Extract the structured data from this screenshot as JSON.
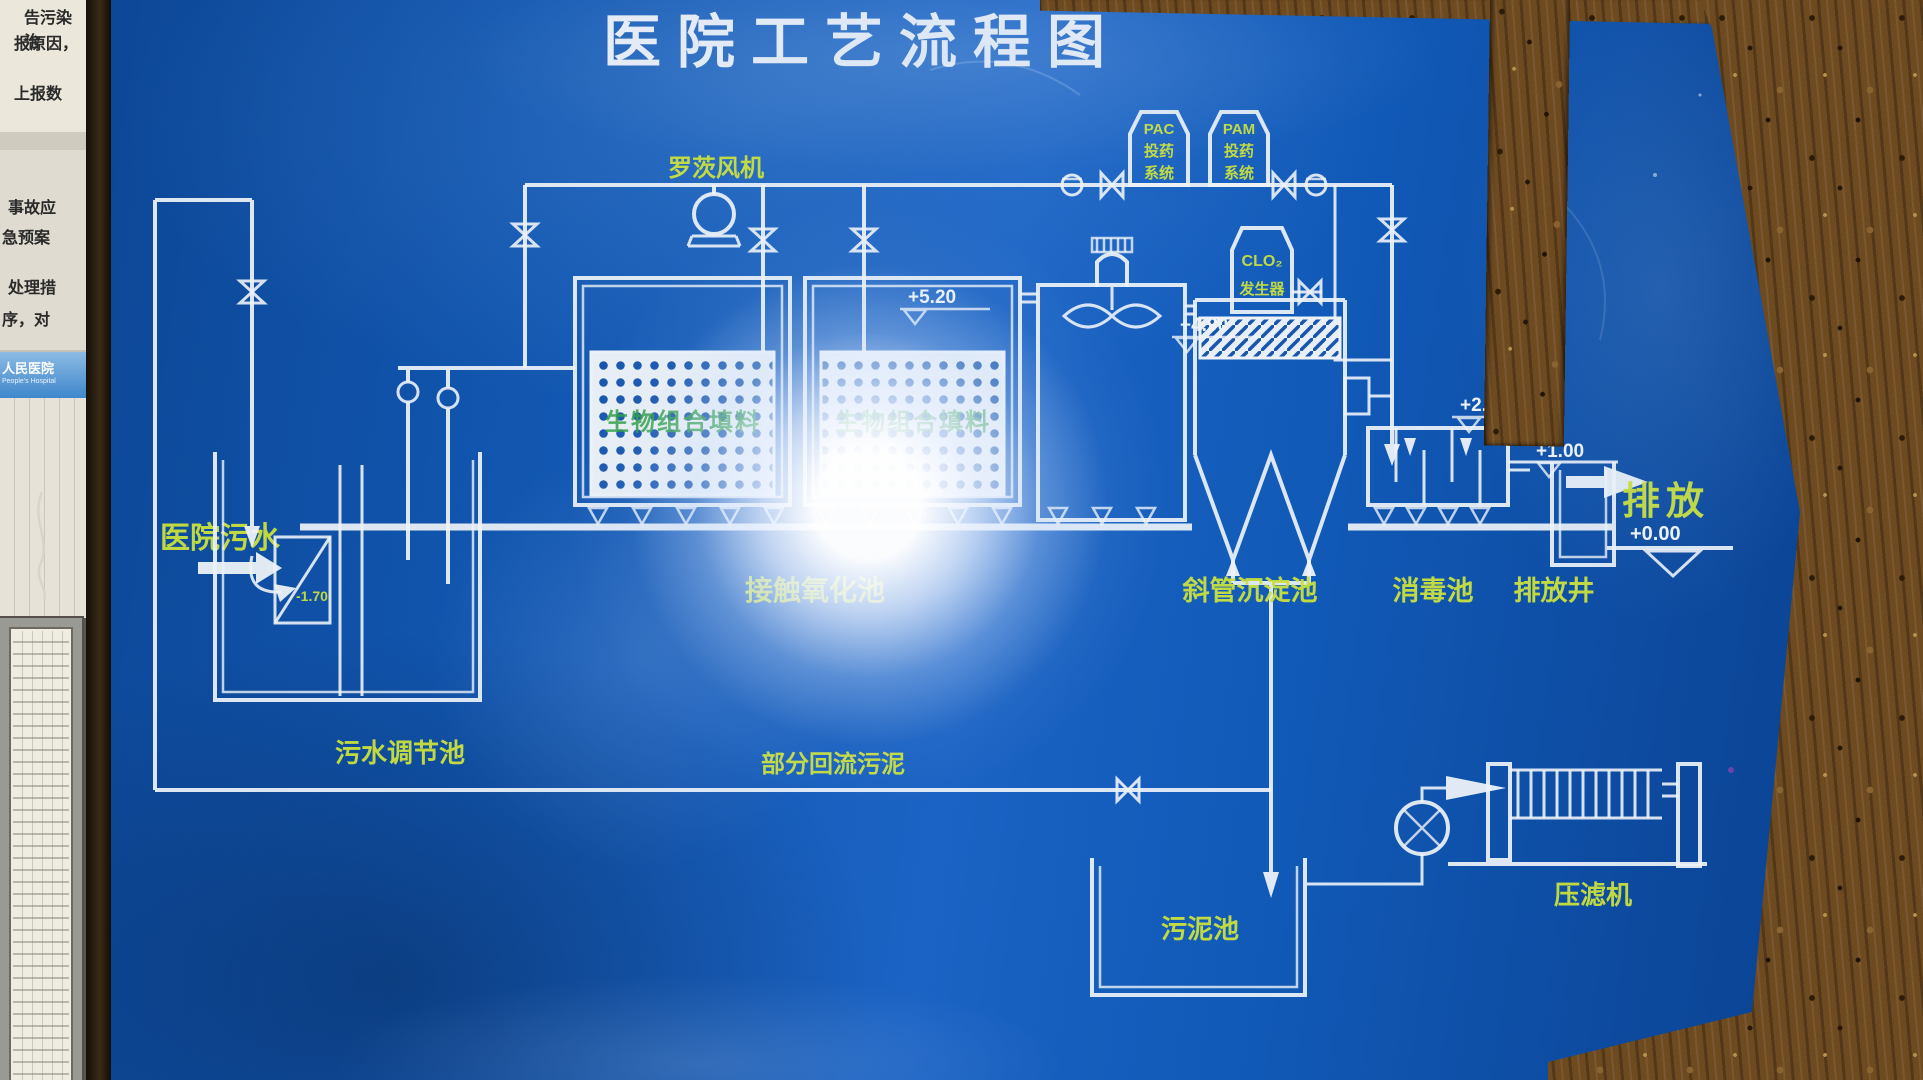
{
  "scene": {
    "board_color": "#1257b4",
    "label_color": "#c9df3e",
    "line_color": "#edf2f8"
  },
  "wall": {
    "fragments": [
      "告污染治",
      "报原因，",
      "上报数",
      "事故应",
      "急预案",
      "处理措",
      "序，对"
    ],
    "sign": {
      "line1": "人民医院",
      "line2": "People's Hospital"
    }
  },
  "diagram": {
    "title": "医院工艺流程图",
    "blower": "罗茨风机",
    "pac_tank": [
      "PAC",
      "投药",
      "系统"
    ],
    "pam_tank": [
      "PAM",
      "投药",
      "系统"
    ],
    "clo2_tank": [
      "CLO₂",
      "发生器"
    ],
    "inlet": "医院污水",
    "units": {
      "regulating": "污水调节池",
      "oxidation": "接触氧化池",
      "media": "生物组合填料",
      "sedimentation": "斜管沉淀池",
      "disinfection": "消毒池",
      "well": "排放井",
      "discharge": "排放",
      "sludge_return": "部分回流污泥",
      "sludge_tank": "污泥池",
      "filter_press": "压滤机"
    },
    "elevations": {
      "screen": "-1.70",
      "oxidation": "+5.20",
      "sedimentation": "+4.90",
      "disinfection": "+2.20",
      "well": "+1.00",
      "discharge": "+0.00"
    }
  }
}
